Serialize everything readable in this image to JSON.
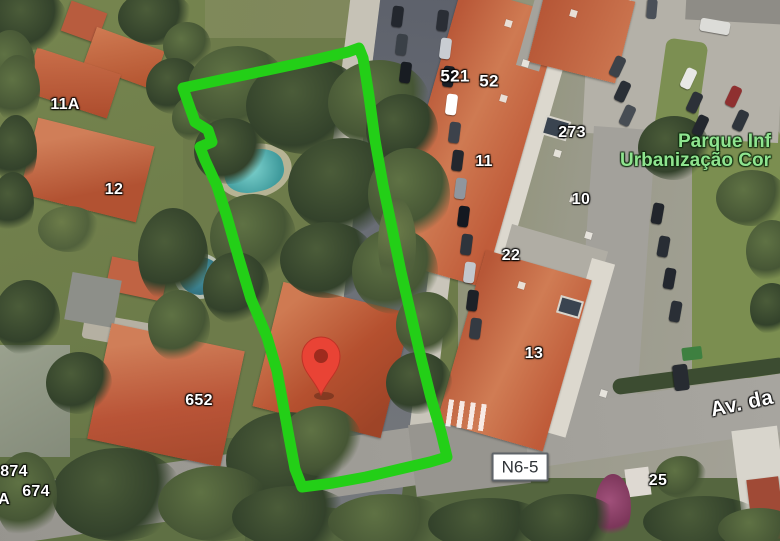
{
  "map": {
    "view": "satellite",
    "labels": {
      "n11a": "11A",
      "n12": "12",
      "n652": "652",
      "n874": "874",
      "n674": "674",
      "partial_a": "A",
      "n521": "521",
      "n52": "52",
      "n11": "11",
      "n273": "273",
      "n10": "10",
      "n22": "22",
      "n13": "13",
      "n25": "25"
    },
    "road_badge": "N6-5",
    "street_name_partial": "Av. da",
    "park_label": {
      "line1": "Parque Inf",
      "line2": "Urbanização Cor"
    },
    "colors": {
      "property_outline_green": "#23CF17",
      "pin_red": "#E94335",
      "pin_inner": "#9E2B1E",
      "park_text_green": "#8FE48F",
      "badge_border_gray": "#5F6469"
    }
  }
}
